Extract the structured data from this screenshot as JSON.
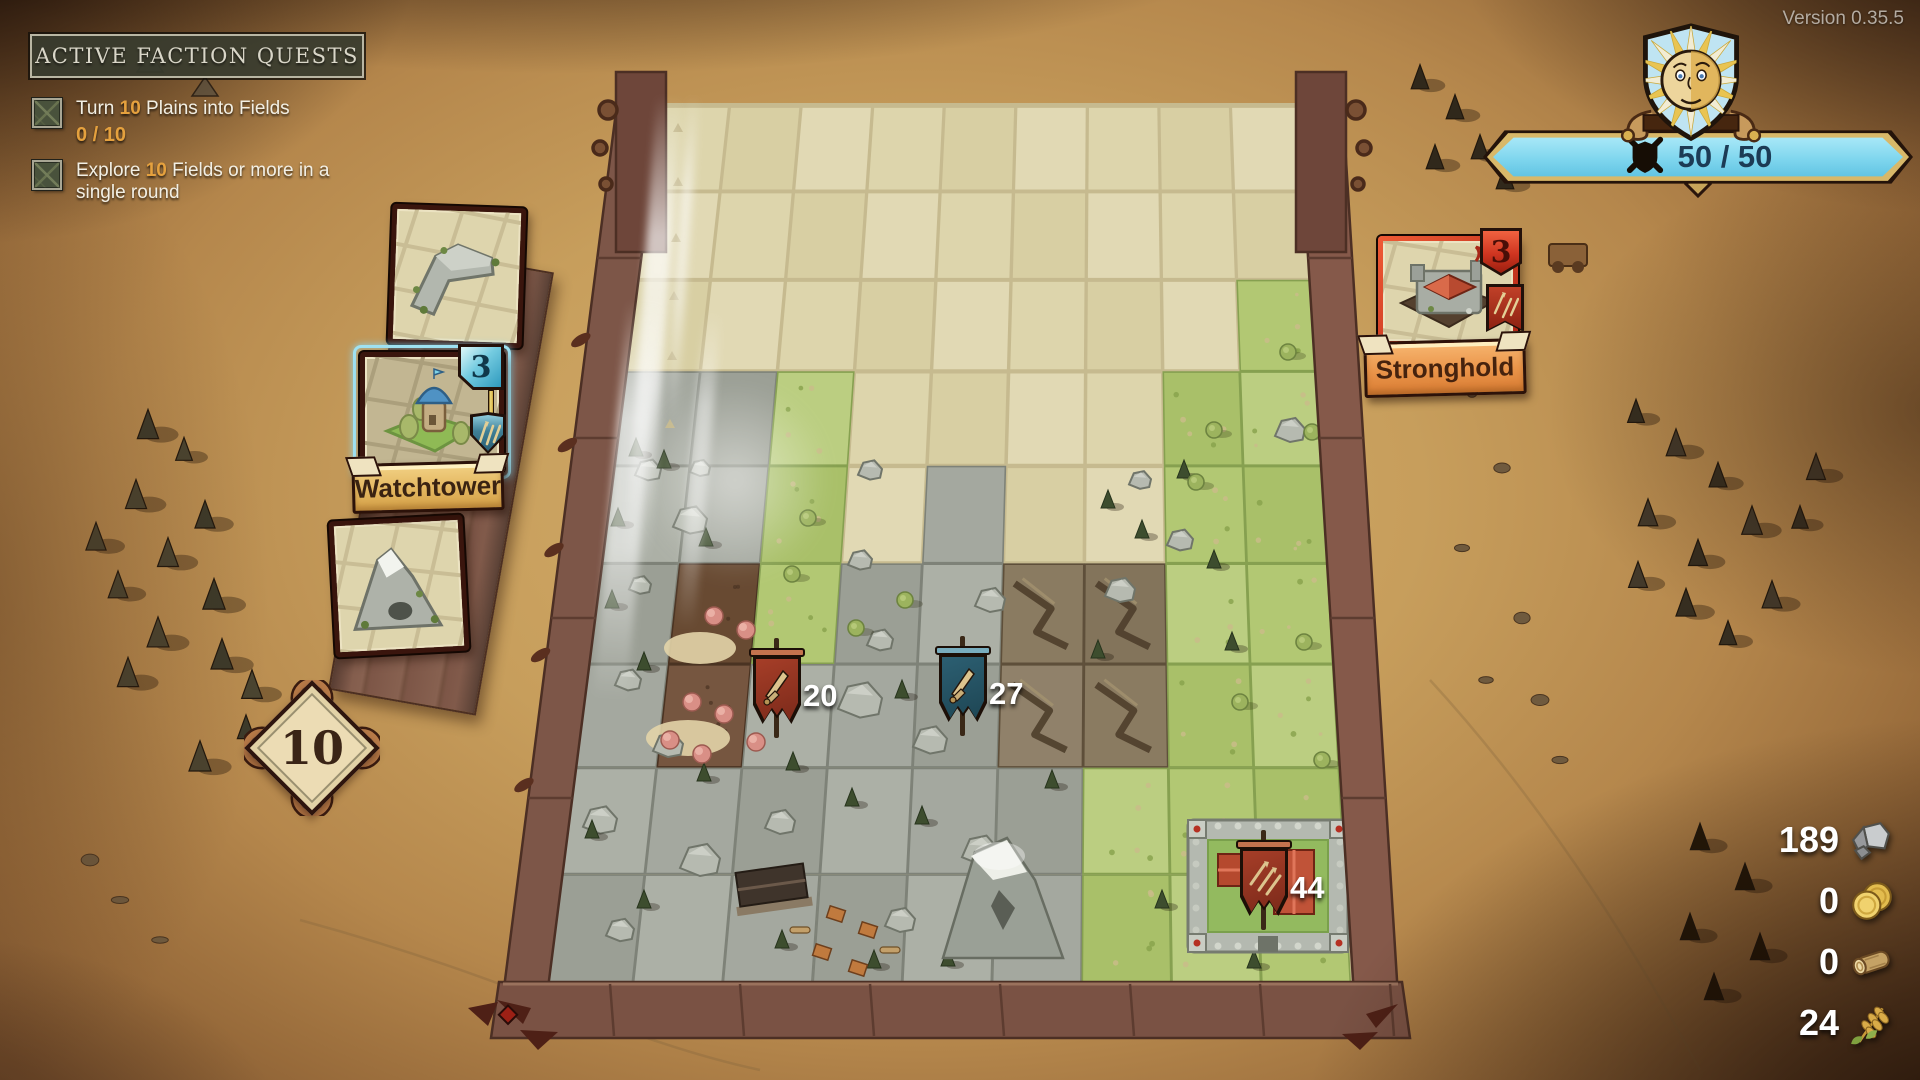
{
  "version_label": "Version 0.35.5",
  "quest_panel": {
    "header": "ACTIVE FACTION QUESTS",
    "quests": [
      {
        "parts": [
          "Turn ",
          "10",
          " Plains into Fields"
        ],
        "progress": "0 / 10",
        "top": 98
      },
      {
        "parts": [
          "Explore ",
          "10",
          " Fields or more in a single round"
        ],
        "progress": "",
        "top": 160
      }
    ]
  },
  "faction_status": {
    "morale": "50 / 50",
    "banner_color": "#7fd6ee"
  },
  "hand": {
    "deck_count": "10",
    "cards": [
      {
        "id": "wall-corner",
        "label": "",
        "count": ""
      },
      {
        "id": "watchtower",
        "label": "Watchtower",
        "count": "3",
        "selected": true
      },
      {
        "id": "mountain",
        "label": "",
        "count": ""
      }
    ]
  },
  "enemy": {
    "card": {
      "id": "stronghold",
      "label": "Stronghold",
      "count": "3"
    }
  },
  "resources": [
    {
      "id": "stone",
      "value": "189",
      "y": 817
    },
    {
      "id": "gold",
      "value": "0",
      "y": 878
    },
    {
      "id": "wood",
      "value": "0",
      "y": 939
    },
    {
      "id": "wheat",
      "value": "24",
      "y": 1000
    }
  ],
  "armies": [
    {
      "id": "red-army-20",
      "value": "20",
      "cloth": "#a63e28",
      "cloth2": "#7c2a1a",
      "bar": "#c4734e",
      "icon": "sword",
      "x": 753,
      "y": 652
    },
    {
      "id": "blue-army-27",
      "value": "27",
      "cloth": "#2c5f72",
      "cloth2": "#1e4654",
      "bar": "#79adbe",
      "icon": "sword",
      "x": 939,
      "y": 650
    },
    {
      "id": "garrison-44",
      "value": "44",
      "cloth": "#a63e28",
      "cloth2": "#7c2a1a",
      "bar": "#c4734e",
      "icon": "arrows",
      "x": 1240,
      "y": 844
    }
  ],
  "board": {
    "cols": 9,
    "rows": 9,
    "corners": {
      "tl": [
        658,
        106
      ],
      "tr": [
        1302,
        106
      ],
      "bl": [
        543,
        984
      ],
      "br": [
        1351,
        984
      ]
    },
    "gap_color": "#c6ba8f",
    "palette": {
      "f": {
        "fills": [
          "#ddd5ac",
          "#d8cfa3",
          "#e1d9b4"
        ],
        "stroke": ""
      },
      "g": {
        "fills": [
          "#b2c873",
          "#a9c069",
          "#bbce81"
        ],
        "stroke": "#86a050"
      },
      "r": {
        "fills": [
          "#a4a89f",
          "#9b9f95",
          "#acb0a6"
        ],
        "stroke": "#7e8278"
      },
      "v": {
        "fills": [
          "#8a7b61",
          "#83745b",
          "#90816a"
        ],
        "stroke": "#5e4f3a"
      },
      "t": {
        "fills": [
          "#6e4f36",
          "#765640",
          "#684a32"
        ],
        "stroke": "#4a3322"
      }
    },
    "map": [
      "fffffffff",
      "fffffffff",
      "ffffffffg",
      "rrgffffgg",
      "rrgfrffgg",
      "rtgrrvvgg",
      "rtrrrvvgg",
      "rrrrrrggg",
      "rrrrrrggg"
    ],
    "features": {
      "boulders": [
        [
          648,
          470,
          26
        ],
        [
          690,
          520,
          34
        ],
        [
          640,
          585,
          22
        ],
        [
          700,
          468,
          20
        ],
        [
          628,
          680,
          26
        ],
        [
          668,
          745,
          30
        ],
        [
          600,
          820,
          34
        ],
        [
          700,
          860,
          40
        ],
        [
          780,
          822,
          30
        ],
        [
          860,
          700,
          44
        ],
        [
          930,
          740,
          34
        ],
        [
          880,
          640,
          26
        ],
        [
          990,
          600,
          30
        ],
        [
          860,
          560,
          24
        ],
        [
          1120,
          590,
          30
        ],
        [
          1180,
          540,
          26
        ],
        [
          1290,
          430,
          30
        ],
        [
          1330,
          380,
          22
        ],
        [
          980,
          850,
          36
        ],
        [
          900,
          920,
          30
        ],
        [
          620,
          930,
          28
        ],
        [
          560,
          760,
          24
        ],
        [
          1140,
          480,
          22
        ],
        [
          870,
          470,
          24
        ]
      ],
      "conifers": [
        [
          636,
          450
        ],
        [
          664,
          462
        ],
        [
          618,
          520
        ],
        [
          706,
          540
        ],
        [
          612,
          602
        ],
        [
          644,
          664
        ],
        [
          793,
          764
        ],
        [
          704,
          775
        ],
        [
          852,
          800
        ],
        [
          922,
          818
        ],
        [
          1108,
          502
        ],
        [
          1142,
          532
        ],
        [
          1184,
          472
        ],
        [
          1214,
          562
        ],
        [
          1232,
          644
        ],
        [
          902,
          692
        ],
        [
          1052,
          782
        ],
        [
          1162,
          902
        ],
        [
          1254,
          962
        ],
        [
          874,
          962
        ],
        [
          782,
          942
        ],
        [
          644,
          902
        ],
        [
          592,
          832
        ],
        [
          1098,
          652
        ],
        [
          1004,
          930
        ],
        [
          948,
          960
        ]
      ],
      "pink_trees": [
        [
          714,
          616
        ],
        [
          746,
          630
        ],
        [
          692,
          702
        ],
        [
          724,
          714
        ],
        [
          670,
          740
        ],
        [
          702,
          754
        ],
        [
          756,
          742
        ]
      ],
      "dust": [
        [
          700,
          648,
          36,
          16
        ],
        [
          688,
          738,
          42,
          18
        ]
      ],
      "map_trees": [
        [
          1288,
          352
        ],
        [
          1312,
          432
        ],
        [
          1338,
          560
        ],
        [
          1304,
          642
        ],
        [
          1322,
          760
        ],
        [
          1286,
          880
        ],
        [
          1240,
          702
        ],
        [
          1214,
          430
        ],
        [
          1196,
          482
        ],
        [
          808,
          518
        ],
        [
          792,
          574
        ],
        [
          856,
          628
        ],
        [
          905,
          600
        ]
      ],
      "fog_marks": [
        [
          678,
          128
        ],
        [
          678,
          182
        ],
        [
          676,
          238
        ],
        [
          674,
          296
        ],
        [
          672,
          356
        ],
        [
          670,
          424
        ]
      ],
      "mountain": [
        1005,
        900
      ],
      "building": [
        772,
        888
      ],
      "camp_huts": [
        [
          836,
          914
        ],
        [
          868,
          930
        ],
        [
          822,
          952
        ],
        [
          858,
          968
        ]
      ],
      "camp_logs": [
        [
          800,
          930
        ],
        [
          890,
          950
        ]
      ],
      "castle": [
        1268,
        886
      ]
    },
    "light_rays": [
      {
        "x": 640,
        "y": 95,
        "w": 26,
        "h": 470,
        "r": 4,
        "o": 0.75
      },
      {
        "x": 676,
        "y": 95,
        "w": 12,
        "h": 330,
        "r": 4,
        "o": 0.6
      },
      {
        "x": 610,
        "y": 300,
        "w": 34,
        "h": 400,
        "r": 5,
        "o": 0.65
      },
      {
        "x": 690,
        "y": 310,
        "w": 18,
        "h": 320,
        "r": 5,
        "o": 0.5
      }
    ],
    "light_glow": {
      "x": 640,
      "y": 380,
      "w": 190,
      "h": 200,
      "o": 0.6
    }
  },
  "decor": {
    "trees_left": [
      [
        148,
        428
      ],
      [
        184,
        452
      ],
      [
        136,
        498
      ],
      [
        205,
        518
      ],
      [
        168,
        556
      ],
      [
        118,
        588
      ],
      [
        214,
        598
      ],
      [
        158,
        636
      ],
      [
        128,
        676
      ],
      [
        222,
        658
      ],
      [
        252,
        688
      ],
      [
        96,
        540
      ],
      [
        246,
        730
      ],
      [
        200,
        760
      ]
    ],
    "trees_right": [
      [
        1636,
        414
      ],
      [
        1676,
        446
      ],
      [
        1718,
        478
      ],
      [
        1648,
        516
      ],
      [
        1698,
        556
      ],
      [
        1752,
        524
      ],
      [
        1686,
        606
      ],
      [
        1638,
        578
      ],
      [
        1728,
        636
      ],
      [
        1772,
        598
      ],
      [
        1800,
        520
      ],
      [
        1816,
        470
      ]
    ],
    "trees_top_right": [
      [
        1420,
        80
      ],
      [
        1455,
        110
      ],
      [
        1480,
        150
      ],
      [
        1505,
        180
      ],
      [
        1435,
        160
      ]
    ],
    "trees_bottom_right": [
      [
        1700,
        840
      ],
      [
        1745,
        880
      ],
      [
        1690,
        930
      ],
      [
        1760,
        950
      ],
      [
        1714,
        990
      ]
    ],
    "pebbles": [
      [
        1452,
        326
      ],
      [
        1472,
        392
      ],
      [
        1502,
        468
      ],
      [
        1462,
        548
      ],
      [
        1522,
        618
      ],
      [
        1486,
        680
      ],
      [
        1540,
        700
      ],
      [
        120,
        900
      ],
      [
        160,
        940
      ],
      [
        90,
        860
      ],
      [
        1560,
        760
      ]
    ],
    "tents": [
      [
        150,
        64
      ],
      [
        205,
        88
      ]
    ],
    "cart": [
      1568,
      256
    ]
  }
}
